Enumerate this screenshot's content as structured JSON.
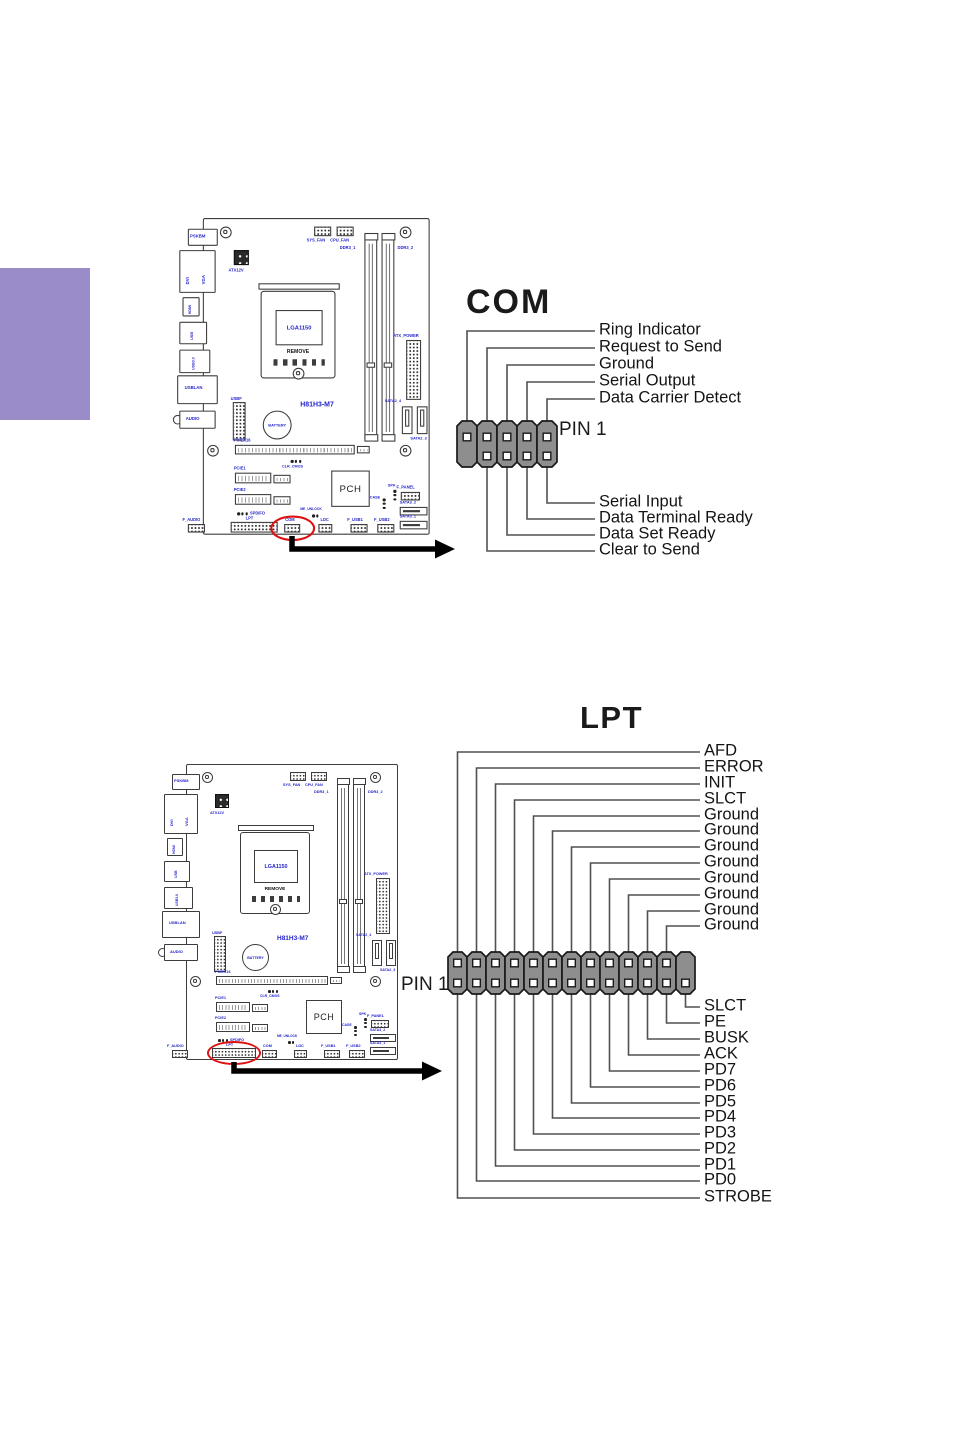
{
  "page": {
    "width": 954,
    "height": 1431
  },
  "colors": {
    "purple": "#9a8cc9",
    "label_blue": "#2424cc",
    "line": "#515151",
    "header_gray": "#8e8e8e",
    "red": "#dd1111",
    "black": "#1a1a1a"
  },
  "com_diagram": {
    "title": "COM",
    "pin1_label": "PIN 1",
    "label_x": 599,
    "header": {
      "left": 457,
      "top": 421,
      "cols": 5,
      "col_w": 20,
      "col_h": 46,
      "pin_top": 16,
      "pin_bot": 35,
      "top_pins": [
        0,
        1,
        2,
        3,
        4
      ],
      "bottom_pins": [
        1,
        2,
        3,
        4
      ]
    },
    "top_labels": [
      {
        "t": "Ring Indicator",
        "y": 331,
        "c": 0
      },
      {
        "t": "Request to Send",
        "y": 348,
        "c": 1
      },
      {
        "t": "Ground",
        "y": 365,
        "c": 2
      },
      {
        "t": "Serial Output",
        "y": 382,
        "c": 3
      },
      {
        "t": "Data Carrier Detect",
        "y": 399,
        "c": 4
      }
    ],
    "bottom_labels": [
      {
        "t": "Serial Input",
        "y": 503,
        "c": 4
      },
      {
        "t": "Data Terminal Ready",
        "y": 519,
        "c": 3
      },
      {
        "t": "Data Set Ready",
        "y": 535,
        "c": 2
      },
      {
        "t": "Clear to Send",
        "y": 551,
        "c": 1
      }
    ]
  },
  "lpt_diagram": {
    "title": "LPT",
    "pin1_label": "PIN 1",
    "label_x": 704,
    "header": {
      "left": 448,
      "top": 952,
      "cols": 13,
      "col_w": 19,
      "col_h": 42,
      "pin_top": 11,
      "pin_bot": 31,
      "top_pins": [
        0,
        1,
        2,
        3,
        4,
        5,
        6,
        7,
        8,
        9,
        10,
        11
      ],
      "bottom_pins": [
        0,
        1,
        2,
        3,
        4,
        5,
        6,
        7,
        8,
        9,
        10,
        11,
        12
      ]
    },
    "top_labels": [
      {
        "t": "AFD",
        "y": 752,
        "c": 0
      },
      {
        "t": "ERROR",
        "y": 768,
        "c": 1
      },
      {
        "t": "INIT",
        "y": 784,
        "c": 2
      },
      {
        "t": "SLCT",
        "y": 800,
        "c": 3
      },
      {
        "t": "Ground",
        "y": 816,
        "c": 4
      },
      {
        "t": "Ground",
        "y": 831,
        "c": 5
      },
      {
        "t": "Ground",
        "y": 847,
        "c": 6
      },
      {
        "t": "Ground",
        "y": 863,
        "c": 7
      },
      {
        "t": "Ground",
        "y": 879,
        "c": 8
      },
      {
        "t": "Ground",
        "y": 895,
        "c": 9
      },
      {
        "t": "Ground",
        "y": 911,
        "c": 10
      },
      {
        "t": "Ground",
        "y": 926,
        "c": 11
      }
    ],
    "bottom_labels": [
      {
        "t": "SLCT",
        "y": 1007,
        "c": 12
      },
      {
        "t": "PE",
        "y": 1023,
        "c": 11
      },
      {
        "t": "BUSK",
        "y": 1039,
        "c": 10
      },
      {
        "t": "ACK",
        "y": 1055,
        "c": 9
      },
      {
        "t": "PD7",
        "y": 1071,
        "c": 8
      },
      {
        "t": "PD6",
        "y": 1087,
        "c": 7
      },
      {
        "t": "PD5",
        "y": 1103,
        "c": 6
      },
      {
        "t": "PD4",
        "y": 1118,
        "c": 5
      },
      {
        "t": "PD3",
        "y": 1134,
        "c": 4
      },
      {
        "t": "PD2",
        "y": 1150,
        "c": 3
      },
      {
        "t": "PD1",
        "y": 1166,
        "c": 2
      },
      {
        "t": "PD0",
        "y": 1181,
        "c": 1
      },
      {
        "t": "STROBE",
        "y": 1198,
        "c": 0
      }
    ]
  },
  "arrows": [
    {
      "name": "com-callout-arrow",
      "pts": [
        [
          292,
          536
        ],
        [
          292,
          549
        ],
        [
          436,
          549
        ]
      ],
      "tip": [
        455,
        549
      ]
    },
    {
      "name": "lpt-callout-arrow",
      "pts": [
        [
          234,
          1062
        ],
        [
          234,
          1071
        ],
        [
          423,
          1071
        ]
      ],
      "tip": [
        442,
        1071
      ]
    }
  ],
  "board": {
    "model": "H81H3-M7",
    "instances": [
      {
        "id": "motherboard-diagram-com",
        "x": 175,
        "y": 218,
        "scale": 1.07,
        "ellipse": {
          "cx": 109.5,
          "cy": 290,
          "rx": 21,
          "ry": 12
        }
      },
      {
        "id": "motherboard-diagram-lpt",
        "x": 160,
        "y": 764,
        "scale": 1.0,
        "ellipse": {
          "cx": 74,
          "cy": 289,
          "rx": 27,
          "ry": 12
        }
      }
    ],
    "components": [
      {
        "n": "board-outline",
        "t": "outline",
        "x": 26,
        "y": 0,
        "w": 212,
        "h": 296
      },
      {
        "n": "screw-hole",
        "t": "scr",
        "x": 42,
        "y": 8,
        "d": 11
      },
      {
        "n": "screw-hole",
        "t": "scr",
        "x": 210,
        "y": 8,
        "d": 11
      },
      {
        "n": "screw-hole",
        "t": "scr",
        "x": 30,
        "y": 212,
        "d": 11
      },
      {
        "n": "screw-hole",
        "t": "scr",
        "x": 210,
        "y": 212,
        "d": 11
      },
      {
        "n": "ps2-keyboard-mouse-port",
        "t": "prt",
        "x": 12,
        "y": 10,
        "w": 28,
        "h": 16,
        "l": "PSKBM",
        "lx": 14,
        "ly": 15,
        "fs": 4
      },
      {
        "n": "dvi-vga-port",
        "t": "prt",
        "x": 4,
        "y": 30,
        "w": 34,
        "h": 40
      },
      {
        "n": "dvi-label",
        "t": "txt",
        "l": "DVI",
        "lx": 10,
        "ly": 62,
        "v": 1,
        "fs": 4
      },
      {
        "n": "vga-label",
        "t": "txt",
        "l": "VGA",
        "lx": 25,
        "ly": 62,
        "v": 1,
        "fs": 4
      },
      {
        "n": "hdmi-port",
        "t": "prt",
        "x": 7,
        "y": 74,
        "w": 16,
        "h": 18
      },
      {
        "n": "hdmi-label",
        "t": "txt",
        "l": "HDMI",
        "lx": 13,
        "ly": 90,
        "v": 1,
        "fs": 3.4
      },
      {
        "n": "usb-port",
        "t": "prt",
        "x": 4,
        "y": 97,
        "w": 26,
        "h": 21
      },
      {
        "n": "usb-label",
        "t": "txt",
        "l": "USB",
        "lx": 15,
        "ly": 114,
        "v": 1,
        "fs": 3.6
      },
      {
        "n": "usb3-port",
        "t": "prt",
        "x": 4,
        "y": 123,
        "w": 29,
        "h": 22
      },
      {
        "n": "usb3-label",
        "t": "txt",
        "l": "USB3.0",
        "lx": 16,
        "ly": 142,
        "v": 1,
        "fs": 3.4
      },
      {
        "n": "usb-lan-port",
        "t": "prt",
        "x": 2,
        "y": 147,
        "w": 38,
        "h": 27,
        "l": "USBLAN",
        "lx": 9,
        "ly": 157,
        "fs": 4
      },
      {
        "n": "audio-jack",
        "t": "scr2",
        "x": -2,
        "y": 184,
        "d": 9
      },
      {
        "n": "audio-port",
        "t": "prt",
        "x": 4,
        "y": 180,
        "w": 34,
        "h": 17,
        "l": "AUDIO",
        "lx": 10,
        "ly": 186,
        "fs": 4
      },
      {
        "n": "sys-fan-header",
        "t": "hdr",
        "x": 130,
        "y": 8,
        "w": 16,
        "h": 9,
        "l": "SYS_FAN",
        "lx": 123,
        "ly": 19,
        "fs": 3.8
      },
      {
        "n": "cpu-fan-header",
        "t": "hdr",
        "x": 151,
        "y": 8,
        "w": 16,
        "h": 9,
        "l": "CPU_FAN",
        "lx": 145,
        "ly": 19,
        "fs": 3.8
      },
      {
        "n": "atx12v-connector",
        "t": "blk",
        "x": 55,
        "y": 30,
        "w": 14,
        "h": 14,
        "l": "ATX12V",
        "lx": 50,
        "ly": 47,
        "fs": 3.8
      },
      {
        "n": "dimm-slot",
        "t": "dimm",
        "x": 177,
        "y": 15,
        "w": 12,
        "h": 192,
        "l": "DDR3_1",
        "lx": 154,
        "ly": 26,
        "fs": 3.8
      },
      {
        "n": "dimm-slot",
        "t": "dimm",
        "x": 193,
        "y": 15,
        "w": 12,
        "h": 192,
        "l": "DDR3_2",
        "lx": 208,
        "ly": 26,
        "fs": 3.8
      },
      {
        "n": "cpu-socket",
        "t": "sock",
        "x": 80,
        "y": 68,
        "w": 70,
        "h": 82,
        "l": "LGA1150",
        "l2": "REMOVE"
      },
      {
        "n": "atx-power-connector",
        "t": "hdr",
        "x": 216,
        "y": 114,
        "w": 14,
        "h": 56,
        "l": "ATX_POWER",
        "lx": 204,
        "ly": 108,
        "fs": 3.8
      },
      {
        "n": "sata-port",
        "t": "sata",
        "x": 212,
        "y": 176,
        "w": 10,
        "h": 26,
        "l": "SATA2_4",
        "lx": 196,
        "ly": 170,
        "fs": 3.6
      },
      {
        "n": "sata-port",
        "t": "sata",
        "x": 226,
        "y": 176,
        "w": 10,
        "h": 26,
        "l": "SATA2_3",
        "lx": 220,
        "ly": 205,
        "fs": 3.6
      },
      {
        "n": "model-name",
        "t": "txt",
        "l": "H81H3-M7",
        "lx": 117,
        "ly": 172,
        "fs": 6.5
      },
      {
        "n": "usbf-header",
        "t": "hdr",
        "x": 54,
        "y": 172,
        "w": 12,
        "h": 36,
        "l": "USBF",
        "lx": 52,
        "ly": 167,
        "fs": 3.8
      },
      {
        "n": "battery",
        "t": "bat",
        "x": 82,
        "y": 180,
        "d": 27,
        "l": "BATTERY"
      },
      {
        "n": "pciex16-slot",
        "t": "slot",
        "x": 56,
        "y": 212,
        "w": 112,
        "h": 9,
        "l": "PCIEX16",
        "lx": 55,
        "ly": 206,
        "fs": 3.8
      },
      {
        "n": "pciex16-latch",
        "t": "slot",
        "x": 170,
        "y": 213,
        "w": 12,
        "h": 7
      },
      {
        "n": "clr-cmos-jumper",
        "t": "jmp",
        "x": 108,
        "y": 226,
        "nd": 3,
        "dir": "h",
        "l": "CLR_CMOS",
        "lx": 100,
        "ly": 231,
        "fs": 3.5
      },
      {
        "n": "pcie1-slot",
        "t": "slot",
        "x": 56,
        "y": 238,
        "w": 34,
        "h": 10,
        "l": "PCIE1",
        "lx": 55,
        "ly": 232,
        "fs": 3.8
      },
      {
        "n": "pcie1-slot-ext",
        "t": "slot",
        "x": 92,
        "y": 240,
        "w": 16,
        "h": 8
      },
      {
        "n": "pcie2-slot",
        "t": "slot",
        "x": 56,
        "y": 258,
        "w": 34,
        "h": 10,
        "l": "PCIE2",
        "lx": 55,
        "ly": 252,
        "fs": 3.8
      },
      {
        "n": "pcie2-slot-ext",
        "t": "slot",
        "x": 92,
        "y": 260,
        "w": 16,
        "h": 8
      },
      {
        "n": "pch-chip",
        "t": "chip",
        "x": 146,
        "y": 236,
        "w": 36,
        "h": 34,
        "l": "PCH"
      },
      {
        "n": "spdifo-header",
        "t": "jmp",
        "x": 58,
        "y": 275,
        "nd": 3,
        "dir": "h",
        "l": "SPDIFO",
        "lx": 70,
        "ly": 274,
        "fs": 3.8
      },
      {
        "n": "lpt-header",
        "t": "hdr",
        "x": 52,
        "y": 284,
        "w": 44,
        "h": 10,
        "l": "LPT",
        "lx": 66,
        "ly": 279,
        "fs": 3.8
      },
      {
        "n": "f-audio-header",
        "t": "hdr",
        "x": 12,
        "y": 286,
        "w": 16,
        "h": 8,
        "l": "F_AUDIO",
        "lx": 7,
        "ly": 280,
        "fs": 3.8
      },
      {
        "n": "com-header",
        "t": "hdr",
        "x": 102,
        "y": 286,
        "w": 15,
        "h": 8,
        "l": "COM",
        "lx": 103,
        "ly": 280,
        "fs": 3.8
      },
      {
        "n": "me-unlock-jumper",
        "t": "jmp",
        "x": 128,
        "y": 277,
        "nd": 2,
        "dir": "h",
        "l": "ME_UNLOCK",
        "lx": 117,
        "ly": 271,
        "fs": 3.2
      },
      {
        "n": "ldc-header",
        "t": "hdr",
        "x": 134,
        "y": 286,
        "w": 13,
        "h": 8,
        "l": "LDC",
        "lx": 136,
        "ly": 280,
        "fs": 3.8
      },
      {
        "n": "f-usb1-header",
        "t": "hdr",
        "x": 164,
        "y": 286,
        "w": 16,
        "h": 8,
        "l": "F_USB1",
        "lx": 161,
        "ly": 280,
        "fs": 3.8
      },
      {
        "n": "f-usb2-header",
        "t": "hdr",
        "x": 189,
        "y": 286,
        "w": 16,
        "h": 8,
        "l": "F_USB2",
        "lx": 186,
        "ly": 280,
        "fs": 3.8
      },
      {
        "n": "case-jumper",
        "t": "jmp",
        "x": 194,
        "y": 262,
        "nd": 3,
        "dir": "v",
        "l": "CASE",
        "lx": 182,
        "ly": 260,
        "fs": 3.5
      },
      {
        "n": "spk-jumper",
        "t": "jmp",
        "x": 204,
        "y": 254,
        "nd": 3,
        "dir": "v",
        "l": "SPK",
        "lx": 199,
        "ly": 249,
        "fs": 3.5
      },
      {
        "n": "f-panel-header",
        "t": "hdr",
        "x": 211,
        "y": 256,
        "w": 18,
        "h": 8,
        "l": "F_PANEL",
        "lx": 207,
        "ly": 250,
        "fs": 3.8
      },
      {
        "n": "sata-port",
        "t": "sata",
        "x": 210,
        "y": 270,
        "w": 26,
        "h": 8,
        "l": "SATA3_2",
        "lx": 210,
        "ly": 265,
        "fs": 3.6
      },
      {
        "n": "sata-port",
        "t": "sata",
        "x": 210,
        "y": 283,
        "w": 26,
        "h": 8,
        "l": "SATA3_1",
        "lx": 210,
        "ly": 278,
        "fs": 3.6
      }
    ]
  }
}
